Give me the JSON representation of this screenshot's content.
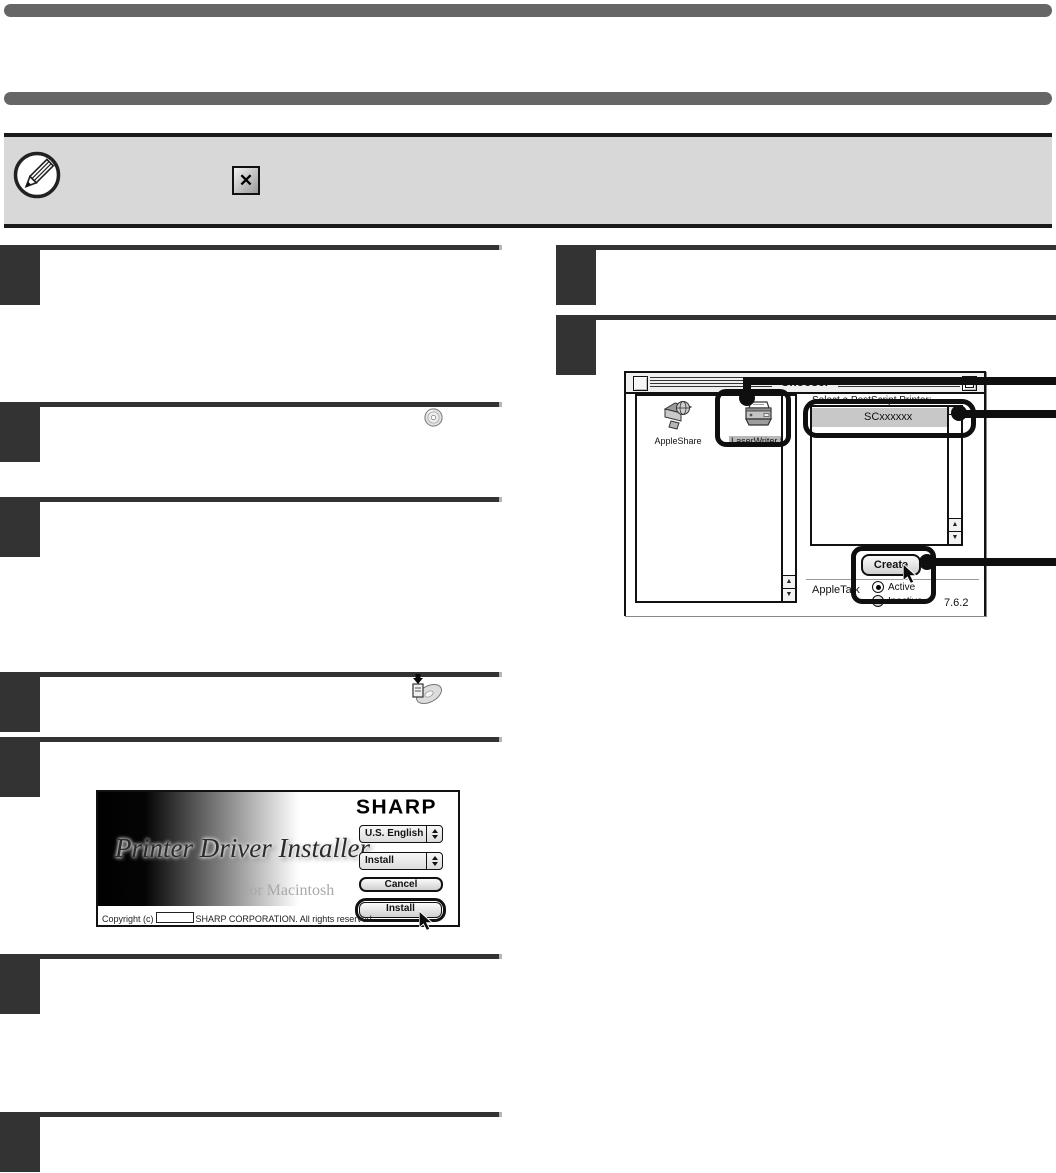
{
  "colors": {
    "bar_gray": "#666666",
    "note_background": "#d8d8d8",
    "step_ink": "#333333",
    "callout_black": "#0f0f0f",
    "selection_gray": "#c8c8c8"
  },
  "note": {
    "close_button_glyph": "✕"
  },
  "chooser": {
    "window_title": "Chooser",
    "device_list": [
      {
        "label": "AppleShare",
        "selected": false
      },
      {
        "label": "LaserWriter 8",
        "selected": true
      }
    ],
    "printer_panel": {
      "heading": "Select a PostScript Printer:",
      "items": [
        {
          "name": "SCxxxxxx",
          "selected": true
        }
      ],
      "create_button": "Create"
    },
    "appletalk": {
      "label": "AppleTalk",
      "active_label": "Active",
      "inactive_label": "Inactive",
      "selected": "Active"
    },
    "version": "7.6.2",
    "scroll_up_glyph": "▲",
    "scroll_down_glyph": "▼"
  },
  "installer": {
    "brand": "SHARP",
    "title": "Printer Driver Installer",
    "subtitle": "for Macintosh",
    "language_popup_value": "U.S. English",
    "action_popup_value": "Install",
    "cancel_button": "Cancel",
    "install_button": "Install",
    "copyright_prefix": "Copyright (c)",
    "copyright_suffix": "SHARP CORPORATION. All rights reserved."
  }
}
